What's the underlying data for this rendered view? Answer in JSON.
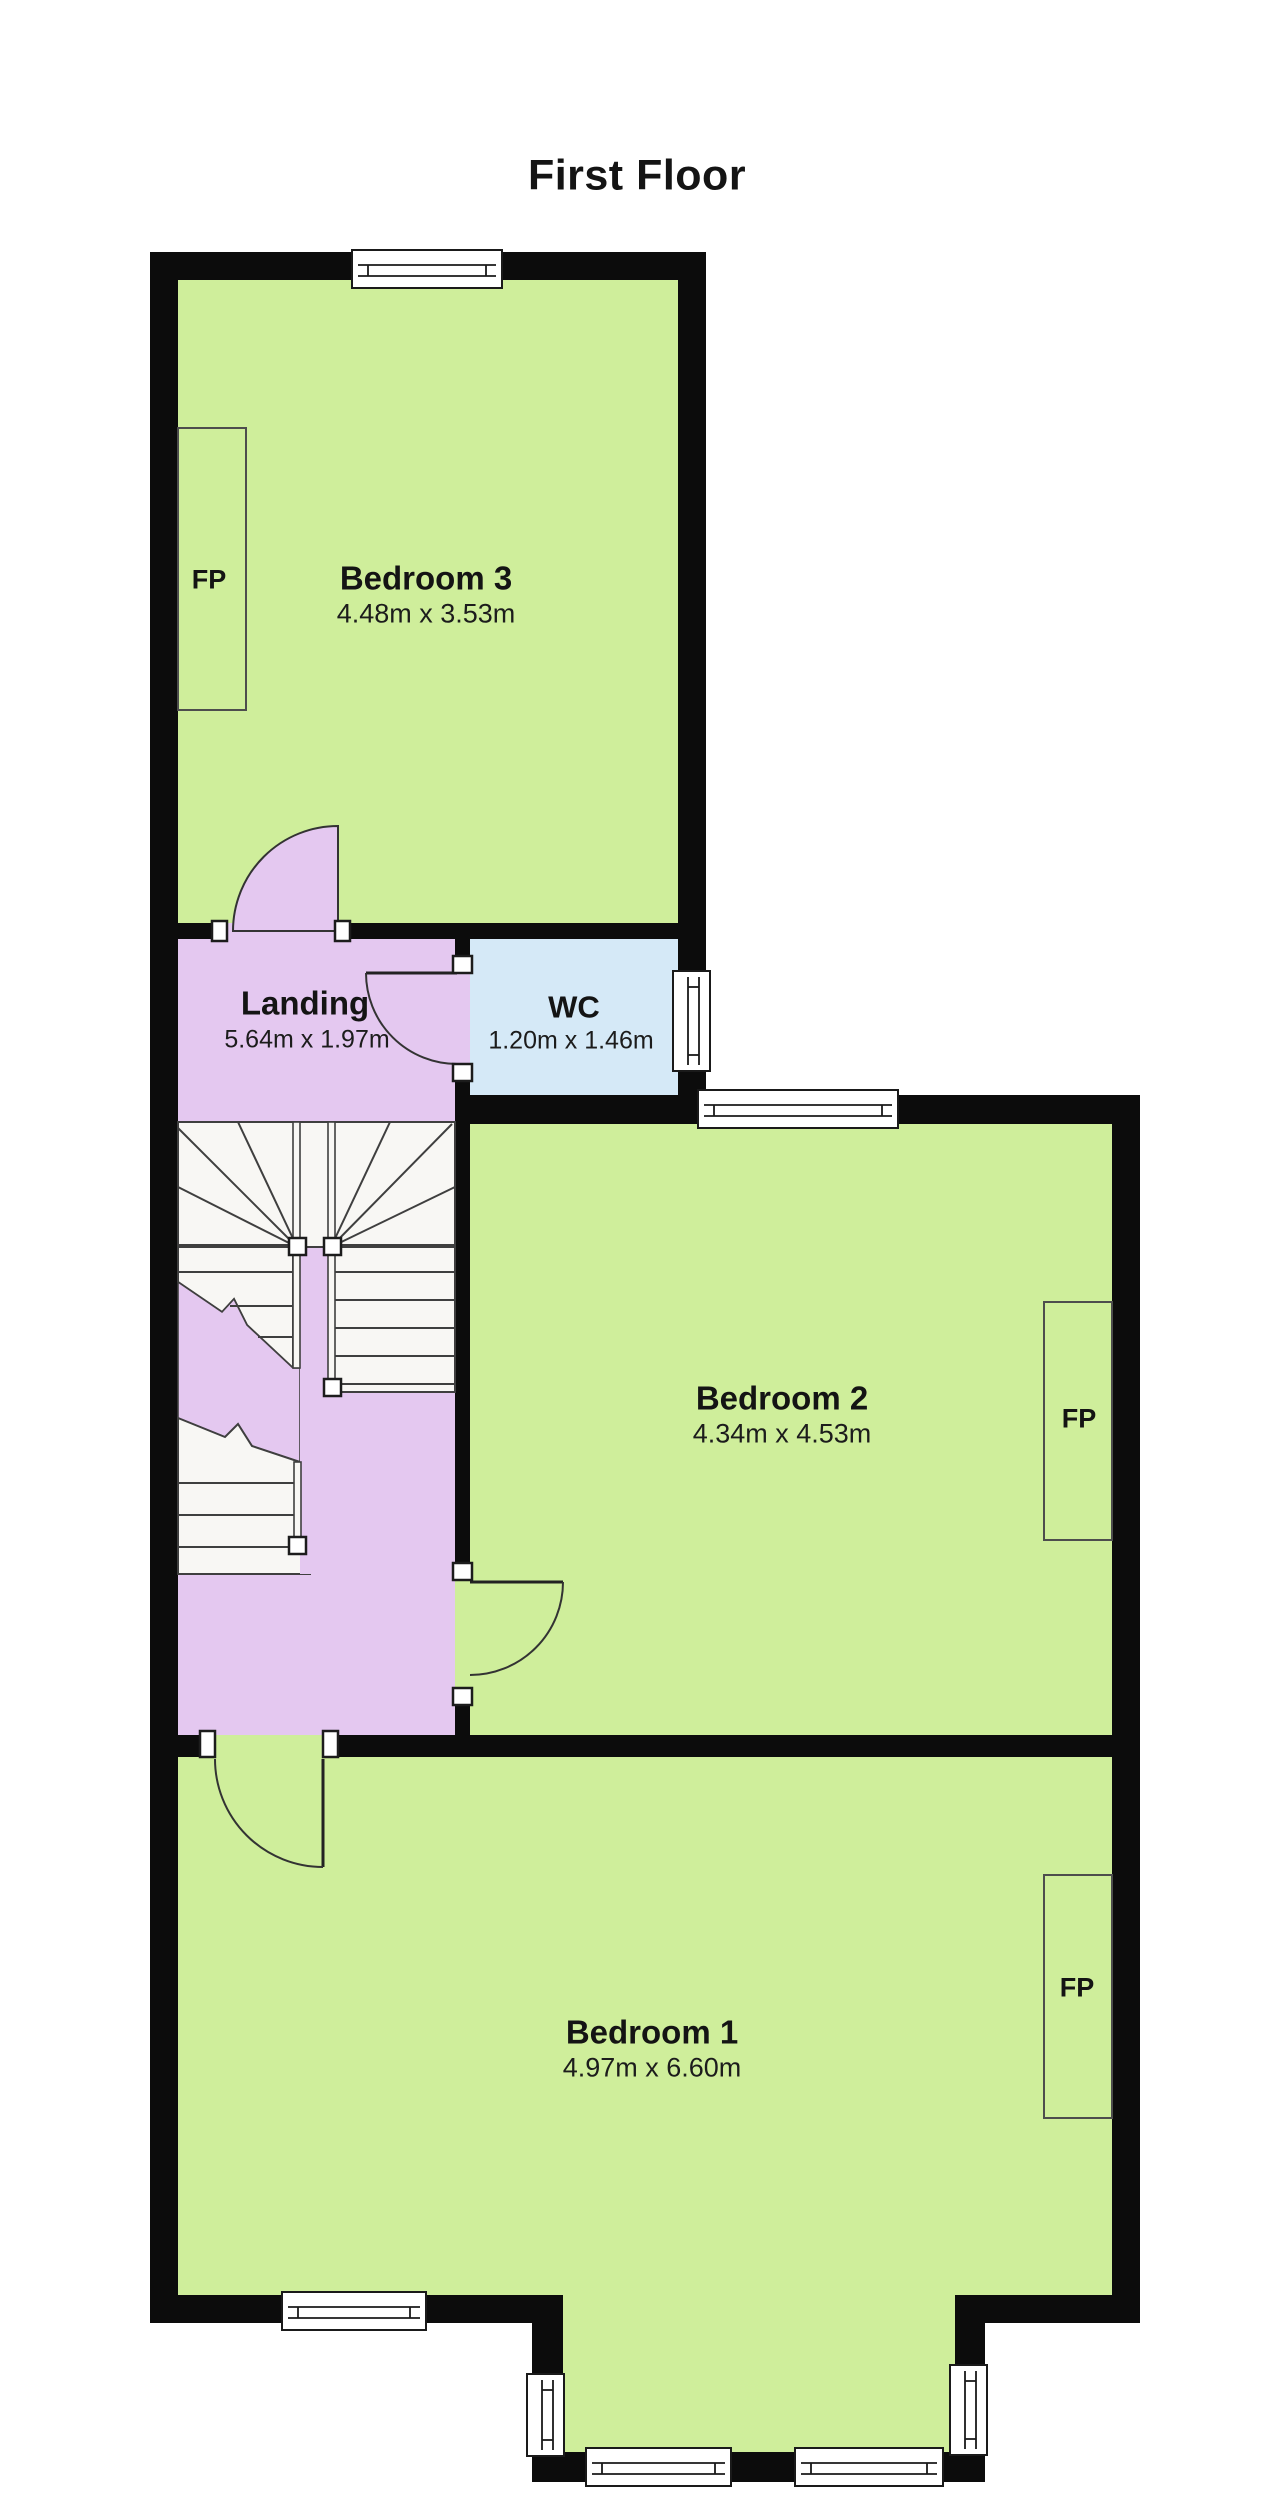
{
  "title": "First Floor",
  "rooms": {
    "bedroom3": {
      "name": "Bedroom 3",
      "dims": "4.48m x 3.53m"
    },
    "landing": {
      "name": "Landing",
      "dims": "5.64m x 1.97m"
    },
    "wc": {
      "name": "WC",
      "dims": "1.20m x 1.46m"
    },
    "bedroom2": {
      "name": "Bedroom 2",
      "dims": "4.34m x 4.53m"
    },
    "bedroom1": {
      "name": "Bedroom 1",
      "dims": "4.97m x 6.60m"
    }
  },
  "fixtures": {
    "fireplace_label": "FP"
  },
  "colors": {
    "room_fill": "#cfee9b",
    "landing_fill": "#e4c8f0",
    "wc_fill": "#d5e9f7",
    "wall": "#0c0c0c"
  }
}
